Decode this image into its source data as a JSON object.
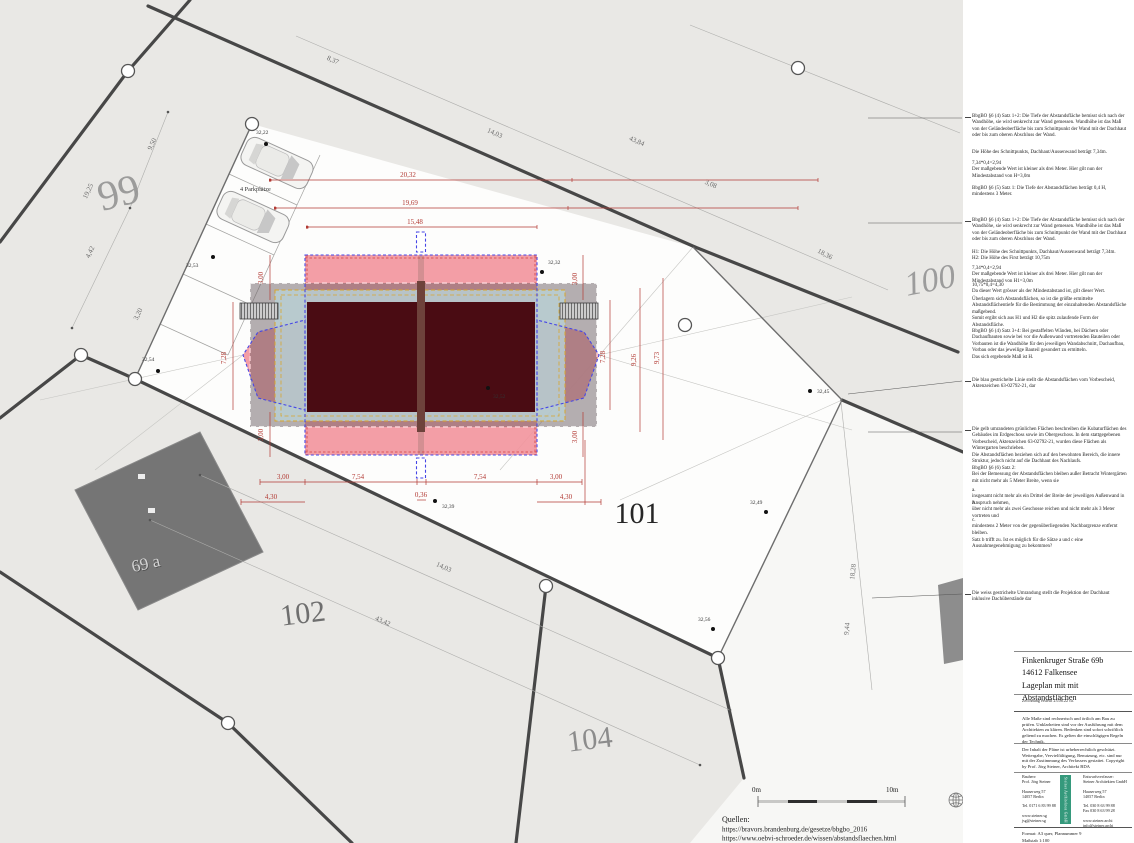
{
  "colors": {
    "abstand_pink": "#f2949c",
    "vorbescheid_blue": "#4646e6",
    "wintergarten_yellow": "#d9a62c",
    "building_maroon": "#4a0c13",
    "dachhaut_gray": "#6e6266",
    "dim_red": "#b23a34",
    "logo_green": "#35997c",
    "parcel_gray": "#e9e8e5"
  },
  "plan": {
    "parcels": {
      "p99": "99",
      "p100": "100",
      "p101": "101",
      "p102": "102",
      "p104": "104",
      "p69a": "69 a"
    },
    "parking_label": "4 Parkplätze",
    "red_dims": {
      "top1": "20,32",
      "top2": "19,69",
      "top3": "15,48",
      "b_left3": "3,00",
      "b_left754": "7,54",
      "b_mid036": "0,36",
      "b_right754": "7,54",
      "b_right3": "3,00",
      "b_left430": "4,30",
      "b_right430": "4,30",
      "v_left728": "7,28",
      "v_right728": "7,28",
      "v_926": "9,26",
      "v_973": "9,73",
      "v3_tl": "3,00",
      "v3_bl": "3,00",
      "v3_tr": "3,00",
      "v3_br": "3,00"
    },
    "gray_dims": {
      "g837": "8,37",
      "g1403t": "14,03",
      "g4384": "43,84",
      "g308": "3,08",
      "g1836": "18,36",
      "g950": "9,50",
      "g1925": "19,25",
      "g442": "4,42",
      "g320": "3,20",
      "g1403b": "14,03",
      "g4342": "43,42",
      "g1828": "18,28",
      "g944": "9,44"
    },
    "spots": {
      "s1": "32,22",
      "s2": "32,53",
      "s3": "32,54",
      "s4": "32,32",
      "s5": "32,52",
      "s6": "32,45",
      "s7": "32,39",
      "s8": "32,49",
      "s9": "32,56"
    }
  },
  "scalebar": {
    "left": "0m",
    "right": "10m"
  },
  "sources": {
    "label": "Quellen:",
    "url1": "https://bravors.brandenburg.de/gesetze/bbgbo_2016",
    "url2": "https://www.oebvi-schroeder.de/wissen/abstandsflaechen.html"
  },
  "notes": {
    "n1": "BbgBO §6 (4) Satz 1+2: Die Tiefe der Abstandsfläche bemisst sich nach der Wandhöhe, sie wird senkrecht zur Wand gemessen. Wandhöhe ist das Maß von der Geländeoberfläche bis zum Schnittpunkt der Wand mit der Dachhaut oder bis zum oberen Abschluss der Wand.",
    "n2": "Die Höhe des Schnittpunkts, Dachhaut/Aussenwand beträgt 7,34m.",
    "n3": "7,34*0,4=2,94\nDer maßgebende Wert ist kleiner als drei Meter. Hier gilt nun der Mindestabstand von H=3,0m",
    "n4": "BbgBO §6 (5) Satz 1: Die Tiefe der Abstandsflächen beträgt 0,4 H, mindestens 3 Meter.",
    "n5": "BbgBO §6 (4) Satz 1+2: Die Tiefe der Abstandsfläche bemisst sich nach der Wandhöhe, sie wird senkrecht zur Wand gemessen. Wandhöhe ist das Maß von der Geländeoberfläche bis zum Schnittpunkt der Wand mit der Dachhaut oder bis zum oberen Abschluss der Wand.",
    "n6": "H1: Die Höhe des Schnittpunkts, Dachhaut/Aussenwand beträgt 7,34m.\nH2: Die Höhe des First beträgt 10,75m",
    "n7": "7,34*0,4=2,94\nDer maßgebende Wert ist kleiner als drei Meter. Hier gilt nun der Mindestabstand von H1=3,0m",
    "n8": "10,75*0,4=4,30\nDa dieser Wert grösser als der Mindestabstand ist, gilt dieser Wert.",
    "n9": "Überlagern sich Abstandsflächen, so ist die größte ermittelte Abstandsflächentiefe für die Bestimmung der einzuhaltenden Abstandsfläche maßgebend.\nSomit ergibt sich aus H1 und H2 die spitz zulaufende Form der Abstandsfläche.",
    "n10": "BbgBO §6 (4) Satz 3+4: Bei gestaffelten Wänden, bei Dächern oder Dachaufbauten sowie bei vor die Außenwand vortretenden Bauteilen oder Vorbauten ist die Wandhöhe für den jeweiligen Wandabschnitt, Dachaufbau, Vorbau oder das jeweilige Bauteil gesondert zu ermitteln.\nDas sich ergebende Maß ist H.",
    "n11": "Die blau gestrichelte Linie stellt die Abstandsflächen vom Vorbescheid, Aktenzeichen 63-02792-21, dar",
    "n12": "Die gelb umrandeten grünlichen Flächen beschreiben die Kubaturflächen des Gebäudes im Erdgeschoss sowie im Obergeschoss. In dem stattgegebenen Vorbescheid, Aktenzeichen 63-02792-21, wurden diese Flächen als Wintergarten beschrieben.\nDie Abstandsflächen beziehen sich auf den bewohnten Bereich, die innere Struktur, jedoch nicht auf die Dachhaut des Nachlaufs.",
    "n13": "BbgBO §6 (6) Satz 2:\nBei der Bemessung der Abstandsflächen bleiben außer Betracht Wintergärten mit nicht mehr als 5 Meter Breite, wenn sie",
    "n14": "a.\ninsgesamt nicht mehr als ein Drittel der Breite der jeweiligen Außenwand in Anspruch nehmen,",
    "n15": "b.\nüber nicht mehr als zwei Geschosse reichen und nicht mehr als 3 Meter vortreten und",
    "n16": "c.\nmindestens 2 Meter von der gegenüberliegenden Nachbargrenze entfernt bleiben.",
    "n17": "Satz b trifft zu. Ist es möglich für die Sätze a und c eine Ausnahmegenehmigung zu bekommen?",
    "n18": "Die weiss gestrichelte Umrandung stellt die Projektion der Dachhaut inklusive Dachüberstände dar"
  },
  "titleblock": {
    "title": "Finkenkruger Straße 69b\n14612 Falkensee\nLageplan mit mit Abstandsflächen",
    "created": "Zeichnung erstellt 23.06.22 ca.",
    "note1": "Alle Maße sind rechnerisch und örtlich am Bau zu prüfen. Unklarheiten sind vor der Ausführung mit dem Architekten zu klären. Bedenken sind sofort schriftlich geltend zu machen. Es gelten die einschlägigen Regeln der Technik.",
    "note2": "Der Inhalt der Pläne ist urheberrechtlich geschützt. Weitergabe, Vervielfältigung, Benutzung, etc. sind nur mit der Zustimmung des Verfassers gestattet. Copyright by Prof. Jörg Steiner, Architekt BDA",
    "bauherr": "Bauherr:\nProf. Jörg Steiner\n\nHauserweg 57\n14057 Berlin\n\nTel. 0171 6 83 99 88\n\nwww.steiner.sg\njsg@steiner.sg",
    "logo_text": "Steiner Architekten GmbH",
    "verfasser": "Entwurfsverfasser:\nSteiner Architekten GmbH\n\nHauserweg 57\n14057 Berlin\n\nTel. 030 8 63 99 88\nFax 030 8 63 99 28\n\nwww.steiner.archi\ninfo@steiner.archi",
    "format": "Format: A3 quer, Plannummer 9",
    "scale": "Maßstab 1:100"
  }
}
